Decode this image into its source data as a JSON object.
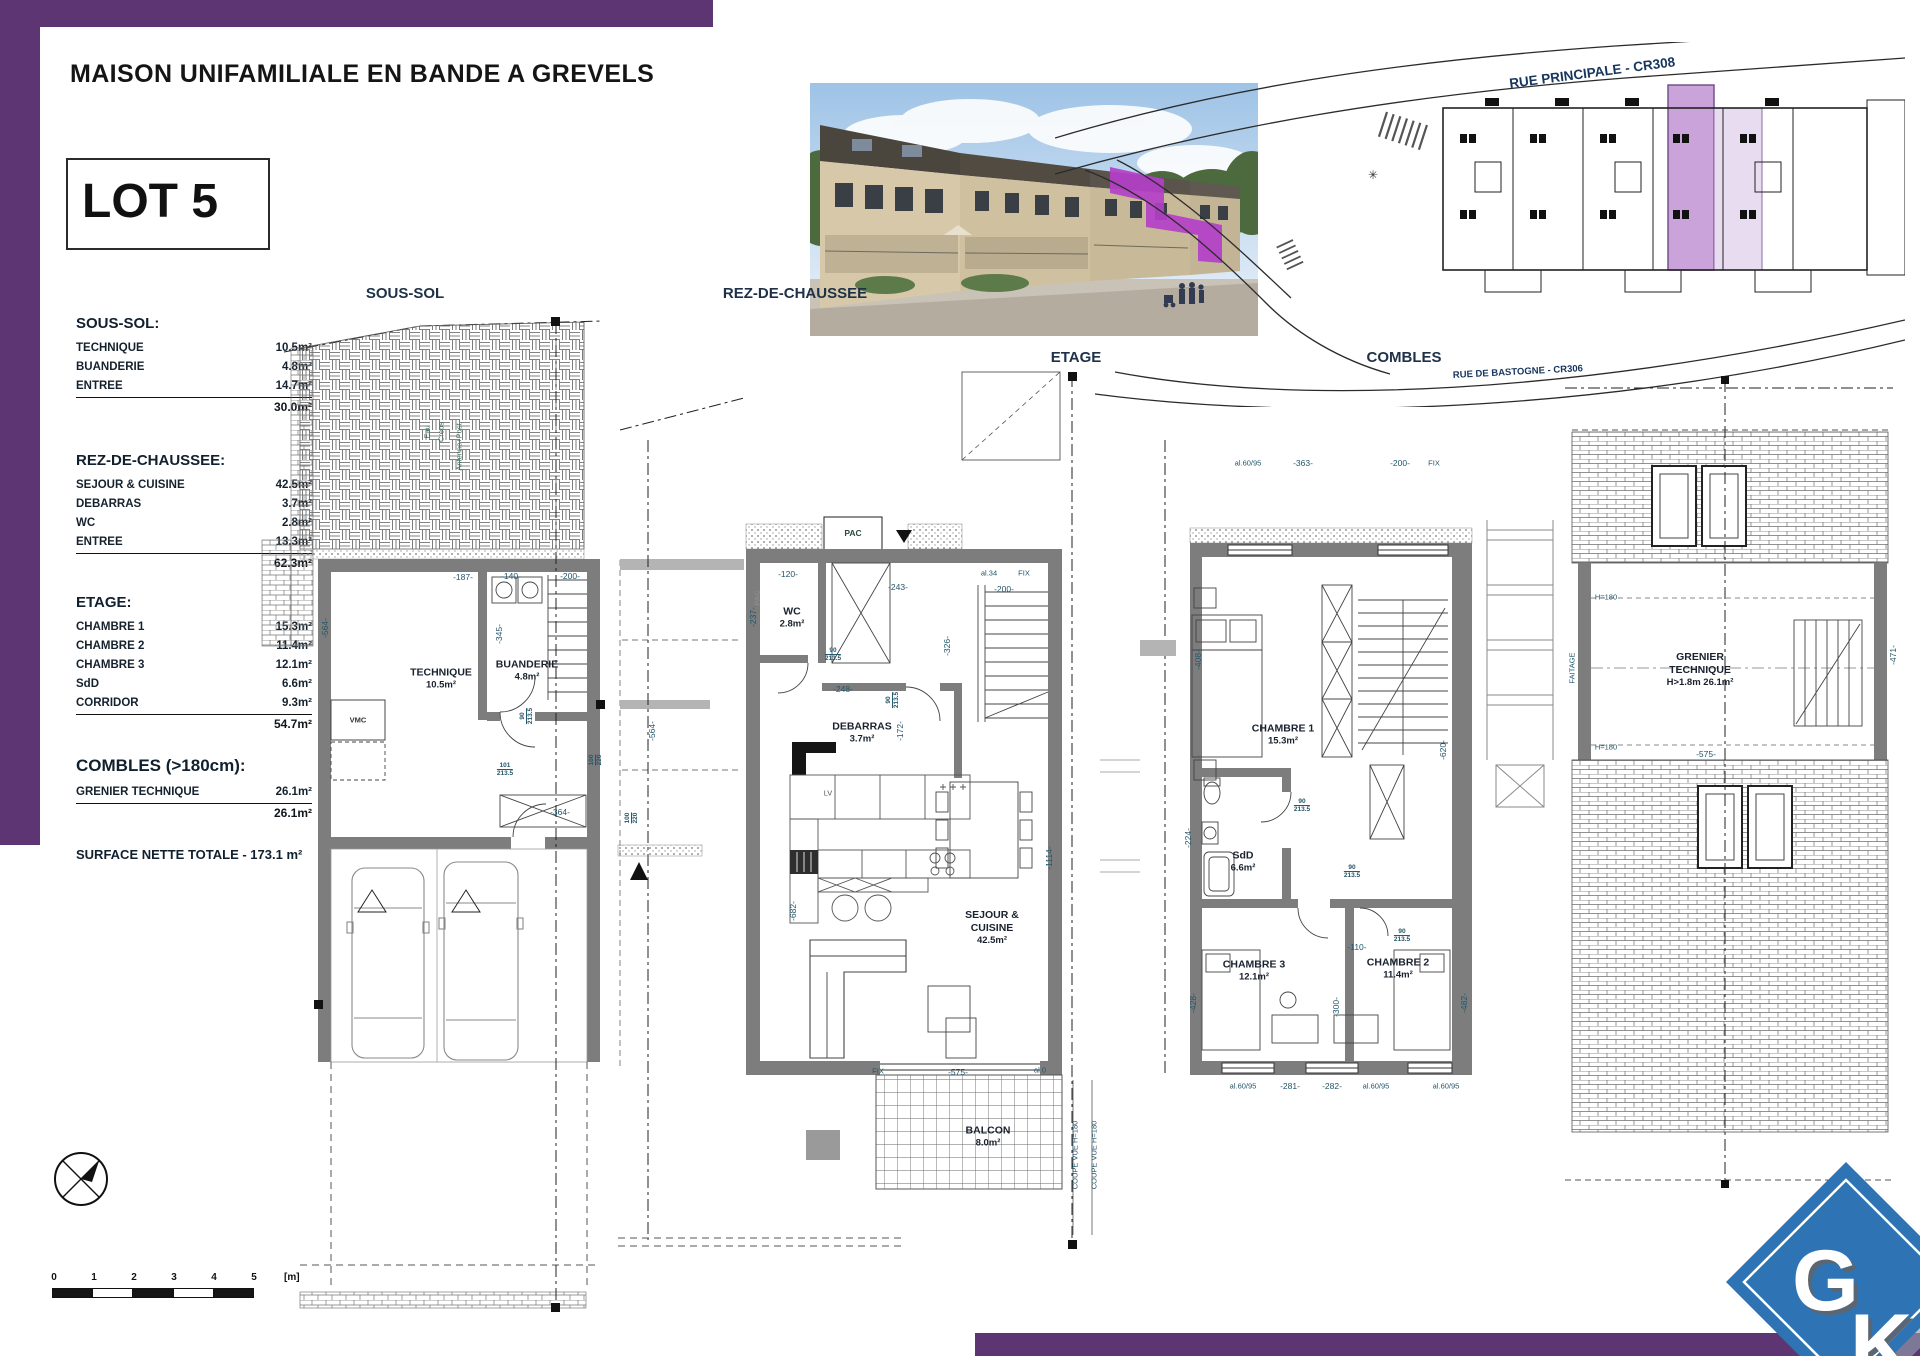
{
  "colors": {
    "purple": "#5d3572",
    "highlight": "#b43fc8",
    "site_purple": "#c9a3d9",
    "site_purple_light": "#e8dcf1",
    "logo_blue": "#2e74b5"
  },
  "header": {
    "title": "MAISON UNIFAMILIALE EN BANDE A GREVELS",
    "lot": "LOT 5"
  },
  "summary": {
    "sections": [
      {
        "title": "SOUS-SOL:",
        "rows": [
          {
            "name": "TECHNIQUE",
            "value": "10.5m²"
          },
          {
            "name": "BUANDERIE",
            "value": "4.8m²"
          },
          {
            "name": "ENTREE",
            "value": "14.7m²"
          }
        ],
        "total": "30.0m²"
      },
      {
        "title": "REZ-DE-CHAUSSEE:",
        "rows": [
          {
            "name": "SEJOUR & CUISINE",
            "value": "42.5m²"
          },
          {
            "name": "DEBARRAS",
            "value": "3.7m²"
          },
          {
            "name": "WC",
            "value": "2.8m²"
          },
          {
            "name": "ENTREE",
            "value": "13.3m²"
          }
        ],
        "total": "62.3m²"
      },
      {
        "title": "ETAGE:",
        "rows": [
          {
            "name": "CHAMBRE 1",
            "value": "15.3m²"
          },
          {
            "name": "CHAMBRE 2",
            "value": "11.4m²"
          },
          {
            "name": "CHAMBRE 3",
            "value": "12.1m²"
          },
          {
            "name": "SdD",
            "value": "6.6m²"
          },
          {
            "name": "CORRIDOR",
            "value": "9.3m²"
          }
        ],
        "total": "54.7m²"
      },
      {
        "title": "COMBLES (>180cm):",
        "rows": [
          {
            "name": "GRENIER TECHNIQUE",
            "value": "26.1m²"
          }
        ],
        "total": "26.1m²"
      }
    ],
    "grand_total": "SURFACE NETTE TOTALE - 173.1 m²"
  },
  "site_plan": {
    "street_top": "RUE PRINCIPALE - CR308",
    "street_bottom": "RUE DE BASTOGNE - CR306"
  },
  "plans": {
    "sous_sol": {
      "heading": "SOUS-SOL",
      "room1": {
        "name": "TECHNIQUE",
        "area": "10.5m²"
      },
      "room2": {
        "name": "BUANDERIE",
        "area": "4.8m²"
      },
      "vmc": "VMC",
      "utilities": [
        "Eau",
        "Creos",
        "Antenne+Post"
      ],
      "dims": [
        "-187-",
        "-140-",
        "-200-",
        "-345-",
        "-364-",
        "-564-"
      ],
      "fracs": [
        {
          "top": "101",
          "bot": "213.5"
        },
        {
          "top": "90",
          "bot": "213.5"
        },
        {
          "top": "100",
          "bot": "220"
        }
      ]
    },
    "rdc": {
      "heading": "REZ-DE-CHAUSSEE",
      "pac": "PAC",
      "pac_side": "PAC",
      "lv": "LV",
      "wc": {
        "name": "WC",
        "area": "2.8m²"
      },
      "debarras": {
        "name": "DEBARRAS",
        "area": "3.7m²"
      },
      "sejour": {
        "line1": "SEJOUR &",
        "line2": "CUISINE",
        "area": "42.5m²"
      },
      "balcon": {
        "name": "BALCON",
        "area": "8.0m²"
      },
      "fix_top": "FIX",
      "fix_bottom": "FIX",
      "al34": "al.34",
      "al0": "al.0",
      "coupe": "COUPE VUE H=180",
      "dims": [
        "-120-",
        "-243-",
        "-200-",
        "-237-",
        "-248-",
        "-172-",
        "-326-",
        "-682-",
        "-1114-",
        "-575-",
        "-564-"
      ],
      "fracs": [
        {
          "top": "90",
          "bot": "213.5"
        },
        {
          "top": "90",
          "bot": "213.5"
        },
        {
          "top": "100",
          "bot": "220"
        }
      ]
    },
    "etage": {
      "heading": "ETAGE",
      "ch1": {
        "name": "CHAMBRE 1",
        "area": "15.3m²"
      },
      "sdd": {
        "name": "SdD",
        "area": "6.6m²"
      },
      "ch3": {
        "name": "CHAMBRE 3",
        "area": "12.1m²"
      },
      "ch2": {
        "name": "CHAMBRE 2",
        "area": "11.4m²"
      },
      "top_dims": [
        "al.60/95",
        "-363-",
        "-200-",
        "FIX"
      ],
      "dims": [
        "-408-",
        "-620-",
        "-224-",
        "-110-",
        "-300-",
        "-428-",
        "-482-"
      ],
      "bottom_dims": [
        "al.60/95",
        "-281-",
        "-282-",
        "al.60/95",
        "al.60/95"
      ],
      "fracs": [
        {
          "top": "90",
          "bot": "213.5"
        },
        {
          "top": "90",
          "bot": "213.5"
        },
        {
          "top": "90",
          "bot": "213.5"
        }
      ]
    },
    "combles": {
      "heading": "COMBLES",
      "grenier": {
        "line1": "GRENIER",
        "line2": "TECHNIQUE",
        "line3": "H>1.8m 26.1m²"
      },
      "faitage": "FAITAGE",
      "h180_a": "H=180",
      "h180_b": "H=180",
      "dims": [
        "-575-",
        "-471-"
      ]
    }
  },
  "scale_bar": {
    "ticks": [
      "0",
      "1",
      "2",
      "3",
      "4",
      "5"
    ],
    "unit": "[m]"
  },
  "logo": {
    "g": "G",
    "k": "K"
  }
}
